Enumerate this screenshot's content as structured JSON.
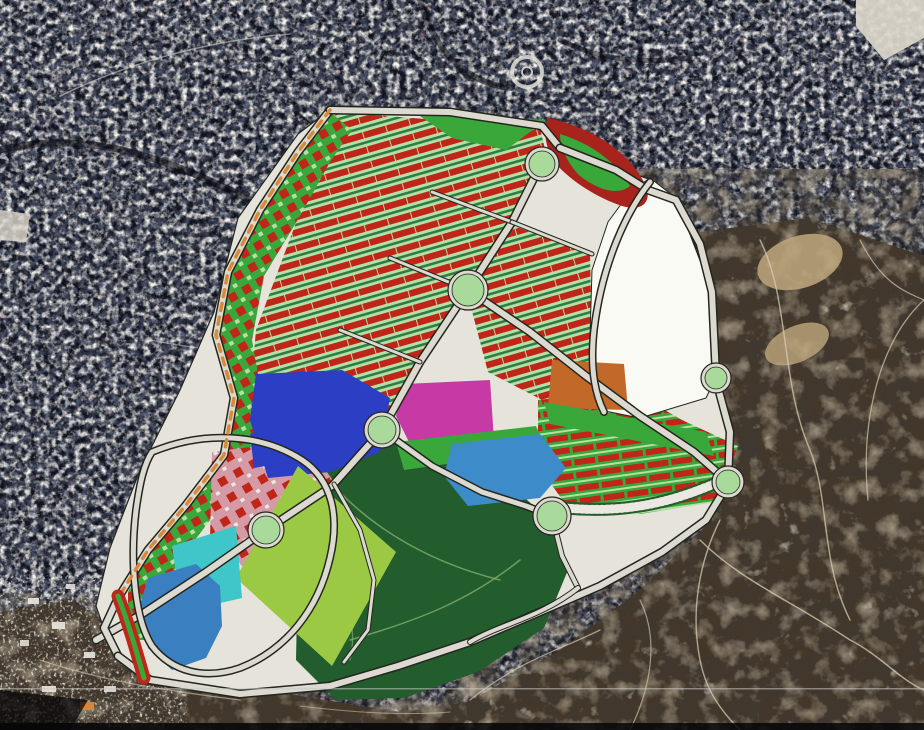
{
  "view": {
    "kind": "aerial-satellite-masterplan-overlay",
    "width": 924,
    "height": 730
  },
  "palette": {
    "city_base": "#10131d",
    "shadow_street": "#07080d",
    "terrain_base": "#43372a",
    "plan_ground": "#e6e4da",
    "plan_white": "#fafaf5",
    "road_fill": "#dcdad0",
    "road_casing": "#23261f",
    "red_block": "#c0251a",
    "dark_red": "#a8231b",
    "light_green": "#b5dfa4",
    "strip_green": "#2e7d46",
    "bright_green": "#3aa73a",
    "park_green": "#235c2d",
    "park_path": "#7fae6b",
    "lime": "#9cc943",
    "royal_blue": "#2b3ec4",
    "magenta": "#c739a5",
    "orange": "#c2692a",
    "steel_blue": "#3d8cc9",
    "turquoise": "#3ec6c8",
    "lake_blue": "#3a7fc0",
    "pink_zone": "#d49aa6",
    "roundabout_green": "#a9d99b",
    "orange_dash": "#d8893a",
    "tan_patch": "#bfa87e",
    "crack": "#d8ccb2",
    "pale": "#eae8e0",
    "white_patch": "#ddd8cc",
    "scanline": "#c9c9c5",
    "black_bar": "#050507"
  },
  "map": {
    "layers": [
      {
        "name": "city-satellite-base",
        "type": "rect",
        "x": 0,
        "y": 0,
        "w": 924,
        "h": 730,
        "fill": "color:city_base"
      },
      {
        "name": "city-satellite-noise",
        "type": "rect",
        "x": 0,
        "y": 0,
        "w": 924,
        "h": 730,
        "filter": "f-city"
      },
      {
        "name": "city-street-curve-1",
        "type": "path",
        "d": "M0,150 C90,128 170,160 250,200 C305,228 332,262 352,300",
        "stroke": "color:shadow_street",
        "sw": 7,
        "op": 0.55
      },
      {
        "name": "city-street-curve-2",
        "type": "path",
        "d": "M420,0 C436,56 470,84 512,88",
        "stroke": "color:shadow_street",
        "sw": 6,
        "op": 0.5
      },
      {
        "name": "city-street-curve-3",
        "type": "path",
        "d": "M60,96 C130,62 210,40 290,34",
        "stroke": "color:pale",
        "sw": 1.6,
        "op": 0.5
      },
      {
        "name": "city-street-curve-4",
        "type": "path",
        "d": "M150,340 C230,356 310,356 372,338",
        "stroke": "color:pale",
        "sw": 1.4,
        "op": 0.45
      },
      {
        "name": "city-street-curve-5",
        "type": "path",
        "d": "M560,40 C600,60 640,64 690,58",
        "stroke": "color:shadow_street",
        "sw": 5,
        "op": 0.5
      },
      {
        "name": "satellite-roundabout-ring",
        "type": "circle",
        "cx": 527,
        "cy": 72,
        "r": 15,
        "stroke": "color:pale",
        "sw": 4,
        "op": 0.8
      },
      {
        "name": "satellite-roundabout-core",
        "type": "circle",
        "cx": 527,
        "cy": 72,
        "r": 5,
        "stroke": "color:pale",
        "sw": 2,
        "op": 0.8
      },
      {
        "name": "white-patch-topright",
        "type": "polygon",
        "pts": "856,0 924,0 924,38 884,60 856,26",
        "fill": "color:white_patch",
        "op": 0.92
      },
      {
        "name": "white-block-leftedge",
        "type": "polygon",
        "pts": "0,210 30,214 26,242 0,240",
        "fill": "color:white_patch",
        "op": 0.8
      },
      {
        "name": "terrain-right",
        "type": "polygon",
        "pts": "700,232 808,218 924,256 924,730 468,730 468,702 560,650 640,590 708,524 732,482 718,378 708,290 668,196",
        "fill": "color:terrain_base"
      },
      {
        "name": "terrain-right-noise",
        "type": "polygon",
        "pts": "700,232 808,218 924,256 924,730 468,730 468,702 560,650 640,590 708,524 732,482 718,378 708,290 668,196",
        "filter": "f-terrain"
      },
      {
        "name": "terrain-bottomleft",
        "type": "polygon",
        "pts": "0,612 70,600 130,636 200,672 300,696 400,712 468,702 468,730 0,730",
        "fill": "color:terrain_base"
      },
      {
        "name": "terrain-bottomleft-noise",
        "type": "polygon",
        "pts": "0,612 70,600 130,636 200,672 300,696 400,712 468,702 468,730 0,730",
        "filter": "f-terrain"
      },
      {
        "name": "terrain-tan-patch-1",
        "type": "ellipse",
        "cx": 800,
        "cy": 262,
        "rx": 44,
        "ry": 26,
        "fill": "color:tan_patch",
        "op": 0.85,
        "tr": "rotate(-18 800 262)"
      },
      {
        "name": "terrain-tan-patch-2",
        "type": "ellipse",
        "cx": 797,
        "cy": 344,
        "rx": 34,
        "ry": 18,
        "fill": "color:tan_patch",
        "op": 0.8,
        "tr": "rotate(-24 797 344)"
      },
      {
        "name": "terrain-track-1",
        "type": "path",
        "d": "M760,240 C790,300 780,380 810,450 C830,500 820,560 850,620",
        "stroke": "color:crack",
        "sw": 1.4,
        "op": 0.75
      },
      {
        "name": "terrain-track-2",
        "type": "path",
        "d": "M924,300 C880,340 860,420 868,500",
        "stroke": "color:crack",
        "sw": 1.3,
        "op": 0.7
      },
      {
        "name": "terrain-track-3",
        "type": "path",
        "d": "M700,540 C740,580 790,600 850,640 C880,655 900,680 924,690",
        "stroke": "color:crack",
        "sw": 1.5,
        "op": 0.75
      },
      {
        "name": "terrain-track-4",
        "type": "path",
        "d": "M470,700 C520,660 560,650 600,630",
        "stroke": "color:crack",
        "sw": 1.3,
        "op": 0.7
      },
      {
        "name": "terrain-track-5",
        "type": "path",
        "d": "M860,240 C880,280 900,290 924,300",
        "stroke": "color:crack",
        "sw": 1.2,
        "op": 0.7
      },
      {
        "name": "terrain-track-6",
        "type": "path",
        "d": "M640,600 C660,640 650,690 630,730",
        "stroke": "color:crack",
        "sw": 1.2,
        "op": 0.65
      },
      {
        "name": "terrain-track-7",
        "type": "path",
        "d": "M720,520 C700,560 690,610 700,660 C706,690 720,710 740,730",
        "stroke": "color:crack",
        "sw": 1.4,
        "op": 0.75
      },
      {
        "name": "terrain-track-8",
        "type": "path",
        "d": "M40,660 C100,680 160,690 240,700",
        "stroke": "color:crack",
        "sw": 1.2,
        "op": 0.6
      },
      {
        "name": "terrain-track-9",
        "type": "path",
        "d": "M300,706 C350,712 400,716 450,712",
        "stroke": "color:crack",
        "sw": 1.1,
        "op": 0.55
      },
      {
        "name": "village-cluster-noise",
        "type": "rect",
        "x": 8,
        "y": 582,
        "w": 170,
        "h": 138,
        "filter": "f-village"
      },
      {
        "name": "village-building",
        "type": "rect",
        "x": 28,
        "y": 598,
        "w": 11,
        "h": 6,
        "fill": "color:pale",
        "op": 0.9
      },
      {
        "name": "village-building",
        "type": "rect",
        "x": 52,
        "y": 622,
        "w": 13,
        "h": 7,
        "fill": "color:pale",
        "op": 0.9
      },
      {
        "name": "village-building",
        "type": "rect",
        "x": 84,
        "y": 652,
        "w": 11,
        "h": 6,
        "fill": "color:pale",
        "op": 0.9
      },
      {
        "name": "village-building",
        "type": "rect",
        "x": 118,
        "y": 600,
        "w": 9,
        "h": 5,
        "fill": "color:pale",
        "op": 0.85
      },
      {
        "name": "village-building",
        "type": "rect",
        "x": 42,
        "y": 686,
        "w": 14,
        "h": 6,
        "fill": "color:pale",
        "op": 0.9
      },
      {
        "name": "village-building",
        "type": "rect",
        "x": 138,
        "y": 642,
        "w": 10,
        "h": 6,
        "fill": "color:pale",
        "op": 0.85
      },
      {
        "name": "village-building",
        "type": "rect",
        "x": 66,
        "y": 584,
        "w": 9,
        "h": 5,
        "fill": "color:pale",
        "op": 0.85
      },
      {
        "name": "village-building",
        "type": "rect",
        "x": 104,
        "y": 686,
        "w": 12,
        "h": 6,
        "fill": "color:pale",
        "op": 0.85
      },
      {
        "name": "village-building",
        "type": "rect",
        "x": 20,
        "y": 640,
        "w": 9,
        "h": 6,
        "fill": "color:pale",
        "op": 0.85
      },
      {
        "name": "orange-building",
        "type": "rect",
        "x": 80,
        "y": 702,
        "w": 14,
        "h": 8,
        "fill": "color:orange_dash",
        "op": 0.95
      },
      {
        "name": "plan-ground",
        "type": "polygon",
        "pts": "332,108 548,124 562,150 652,180 676,198 714,292 718,378 732,432 730,484 708,522 664,554 600,588 540,614 470,644 398,668 330,688 238,696 148,682 112,652 96,606 110,548 140,470 180,390 214,312 238,218 298,134",
        "fill": "color:plan_ground",
        "stroke": "color:road_casing",
        "sw": 1.2
      },
      {
        "name": "park-central",
        "type": "polygon",
        "pts": "294,432 432,444 514,488 558,528 568,570 544,628 478,672 404,698 336,700 296,660 298,560",
        "fill": "color:park_green"
      },
      {
        "name": "park-path-1",
        "type": "path",
        "d": "M320,470 C360,520 420,560 500,580",
        "stroke": "color:park_path",
        "sw": 1.5,
        "op": 0.8
      },
      {
        "name": "park-path-2",
        "type": "path",
        "d": "M350,640 C420,620 470,600 520,560",
        "stroke": "color:park_path",
        "sw": 1.5,
        "op": 0.8
      },
      {
        "name": "park-path-3",
        "type": "path",
        "d": "M300,480 C340,560 360,620 350,660",
        "stroke": "color:park_path",
        "sw": 1.3,
        "op": 0.7
      },
      {
        "name": "zone-residential-north",
        "type": "polygon",
        "pts": "336,112 540,128 548,162 470,292 418,362 378,432 330,472 268,472 248,420 256,330 294,228 318,162",
        "fill": "pattern:rows1"
      },
      {
        "name": "zone-residential-east",
        "type": "polygon",
        "pts": "514,226 590,254 592,340 602,412 546,402 488,372 468,296",
        "fill": "pattern:rows1"
      },
      {
        "name": "zone-westband-mixed",
        "type": "polygon",
        "pts": "330,112 352,130 330,162 300,216 264,276 252,340 264,408 254,462 216,512 186,552 160,592 150,640 128,640 128,592 150,548 188,504 224,454 234,398 216,334 228,272 262,210 298,152",
        "fill": "pattern:check"
      },
      {
        "name": "zone-residential-southeast",
        "type": "polygon",
        "pts": "538,400 630,390 682,420 738,446 716,502 640,514 564,502 538,466",
        "fill": "pattern:rows2"
      },
      {
        "name": "zone-mixeduse-pink",
        "type": "polygon",
        "pts": "212,452 304,440 334,482 318,548 252,574 210,540",
        "fill": "pattern:pink"
      },
      {
        "name": "white-parcel",
        "type": "polygon",
        "pts": "650,178 676,198 712,292 716,377 706,398 640,418 600,410 590,336 592,270 608,222 630,192",
        "fill": "color:plan_white",
        "stroke": "color:road_casing",
        "sw": 1
      },
      {
        "name": "blue-parcel",
        "type": "polygon",
        "pts": "256,374 342,370 390,398 380,452 330,472 268,478 250,420",
        "fill": "color:royal_blue"
      },
      {
        "name": "magenta-parcel",
        "type": "polygon",
        "pts": "404,384 490,380 494,440 414,452 396,416",
        "fill": "color:magenta"
      },
      {
        "name": "orange-parcel",
        "type": "polygon",
        "pts": "552,360 624,364 628,410 548,408",
        "fill": "color:orange"
      },
      {
        "name": "green-band-1",
        "type": "polygon",
        "pts": "396,442 536,426 546,450 404,470",
        "fill": "color:bright_green"
      },
      {
        "name": "green-band-2",
        "type": "polygon",
        "pts": "544,402 706,432 714,456 550,424",
        "fill": "color:bright_green"
      },
      {
        "name": "cyan-parcel",
        "type": "polygon",
        "pts": "452,444 540,434 566,468 540,498 468,506 444,476",
        "fill": "color:steel_blue"
      },
      {
        "name": "lime-parcel",
        "type": "polygon",
        "pts": "298,466 396,552 332,666 236,578",
        "fill": "color:lime"
      },
      {
        "name": "turquoise-parcel",
        "type": "polygon",
        "pts": "172,546 236,526 242,598 182,612",
        "fill": "color:turquoise"
      },
      {
        "name": "lake-parcel",
        "type": "polygon",
        "pts": "148,578 196,564 220,586 222,626 206,658 172,670 148,648 138,612",
        "fill": "color:lake_blue"
      },
      {
        "name": "blue-parcel-small",
        "type": "polygon",
        "pts": "250,434 296,428 300,460 254,468",
        "fill": "color:royal_blue"
      },
      {
        "name": "crescent-red-band",
        "type": "path",
        "d": "M548,118 C592,128 628,150 646,186 C652,202 642,212 622,206 C598,198 572,182 556,164 C546,150 542,132 548,118 Z",
        "fill": "color:dark_red"
      },
      {
        "name": "crescent-green-core",
        "type": "path",
        "d": "M560,134 C592,144 616,162 630,186 C618,196 598,190 580,176 C568,164 560,148 560,134 Z",
        "fill": "color:bright_green"
      },
      {
        "name": "green-triangle-park",
        "type": "polygon",
        "pts": "414,112 546,120 506,150 452,138",
        "fill": "color:bright_green"
      },
      {
        "name": "road-main-avenue",
        "type": "road",
        "d": "M544,158 L512,222 L468,290 L420,362 L382,430 L332,486 L266,530 L206,572 L142,614 L96,640",
        "w": 6,
        "cw": 9
      },
      {
        "name": "road-west-boundary",
        "type": "road",
        "d": "M330,110 L298,152 L260,210 L228,272 L216,335 L234,398 L224,455 L186,505 L148,550 L118,598 L104,628 L118,656",
        "w": 6,
        "cw": 9
      },
      {
        "name": "road-north-edge",
        "type": "road",
        "d": "M330,110 L450,112 L542,126 L560,148",
        "w": 6,
        "cw": 9
      },
      {
        "name": "road-northeast-edge",
        "type": "road",
        "d": "M560,148 L616,170 L648,190 L676,200 L700,244 L712,292 L716,376",
        "w": 6,
        "cw": 9
      },
      {
        "name": "road-east-edge",
        "type": "road",
        "d": "M716,380 L730,432 L728,482",
        "w": 6,
        "cw": 9
      },
      {
        "name": "road-ne-avenue",
        "type": "road",
        "d": "M468,290 L530,332 L586,376 L640,416 L694,452 L726,480",
        "w": 6,
        "cw": 9
      },
      {
        "name": "road-south-ring",
        "type": "road",
        "d": "M728,484 L706,520 L662,552 L600,586 L540,612 L470,642 L398,666 L330,686 L240,694 L150,680 L118,656",
        "w": 6,
        "cw": 9
      },
      {
        "name": "road-mid-link",
        "type": "road",
        "d": "M382,430 L432,466 L482,492 L526,506 L552,516",
        "w": 5,
        "cw": 8
      },
      {
        "name": "road-lake-ring",
        "type": "road",
        "d": "M152,452 C205,430 262,434 302,460 C332,480 340,516 330,558 C318,610 286,650 240,668 C205,680 172,672 152,646 C134,618 130,560 136,510 C140,482 144,464 152,452 Z",
        "w": 5,
        "cw": 8
      },
      {
        "name": "road-whiteparcel-west",
        "type": "road",
        "d": "M650,182 C626,212 602,264 594,330 C590,366 594,392 604,412",
        "w": 5,
        "cw": 8
      },
      {
        "name": "road-cross-1",
        "type": "road",
        "d": "M512,222 L432,192",
        "w": 3,
        "cw": 5
      },
      {
        "name": "road-cross-2",
        "type": "road",
        "d": "M468,290 L390,258",
        "w": 3,
        "cw": 5
      },
      {
        "name": "road-cross-3",
        "type": "road",
        "d": "M420,362 L340,330",
        "w": 3,
        "cw": 5
      },
      {
        "name": "road-cross-4",
        "type": "road",
        "d": "M512,222 L592,254",
        "w": 3,
        "cw": 5
      },
      {
        "name": "road-south-link",
        "type": "road",
        "d": "M552,516 L562,556 L578,588",
        "w": 4,
        "cw": 6
      },
      {
        "name": "road-bottom-curve",
        "type": "road",
        "d": "M470,642 C500,624 540,618 578,588",
        "w": 4,
        "cw": 6
      },
      {
        "name": "road-lime-east",
        "type": "road",
        "d": "M334,484 L360,530 L374,580 L368,630 L344,662",
        "w": 3,
        "cw": 5
      },
      {
        "name": "west-boundary-orange-dashes",
        "type": "path",
        "d": "M330,110 L298,152 L260,210 L228,272 L216,335 L234,398 L224,455 L186,505 L148,550 L118,598",
        "stroke": "color:orange_dash",
        "sw": 3.5,
        "dash": "7 7"
      },
      {
        "name": "hatch-band-dark",
        "type": "path",
        "d": "M566,508 C630,514 676,500 714,484",
        "stroke": "color:park_green",
        "sw": 13
      },
      {
        "name": "hatch-band-ladder",
        "type": "path",
        "d": "M566,508 C630,514 676,500 714,484",
        "stroke": "color:pale",
        "sw": 9,
        "dash": "2 3"
      },
      {
        "name": "redgreen-strip-outer",
        "type": "path",
        "d": "M118,596 C128,622 136,650 144,678",
        "stroke": "color:red_block",
        "sw": 13
      },
      {
        "name": "redgreen-strip-core",
        "type": "path",
        "d": "M118,596 C128,622 136,650 144,678",
        "stroke": "color:bright_green",
        "sw": 5
      },
      {
        "name": "roundabout-top",
        "type": "roundabout",
        "cx": 542,
        "cy": 164,
        "r": 13
      },
      {
        "name": "roundabout-central",
        "type": "roundabout",
        "cx": 468,
        "cy": 290,
        "r": 16
      },
      {
        "name": "roundabout-west",
        "type": "roundabout",
        "cx": 382,
        "cy": 430,
        "r": 14
      },
      {
        "name": "roundabout-lake",
        "type": "roundabout",
        "cx": 266,
        "cy": 530,
        "r": 14
      },
      {
        "name": "roundabout-south",
        "type": "roundabout",
        "cx": 552,
        "cy": 516,
        "r": 15
      },
      {
        "name": "roundabout-northeast",
        "type": "roundabout",
        "cx": 716,
        "cy": 378,
        "r": 11
      },
      {
        "name": "roundabout-east",
        "type": "roundabout",
        "cx": 728,
        "cy": 482,
        "r": 12
      },
      {
        "name": "video-scanline",
        "type": "rect",
        "x": 0,
        "y": 688,
        "w": 924,
        "h": 1.5,
        "fill": "color:scanline",
        "op": 0.55
      },
      {
        "name": "corner-dark-bottomleft",
        "type": "polygon",
        "pts": "0,690 88,700 70,730 0,730",
        "fill": "color:black_bar",
        "op": 0.75
      },
      {
        "name": "bottom-black-bar",
        "type": "rect",
        "x": 0,
        "y": 723,
        "w": 924,
        "h": 7,
        "fill": "color:black_bar",
        "op": 0.85
      }
    ]
  }
}
